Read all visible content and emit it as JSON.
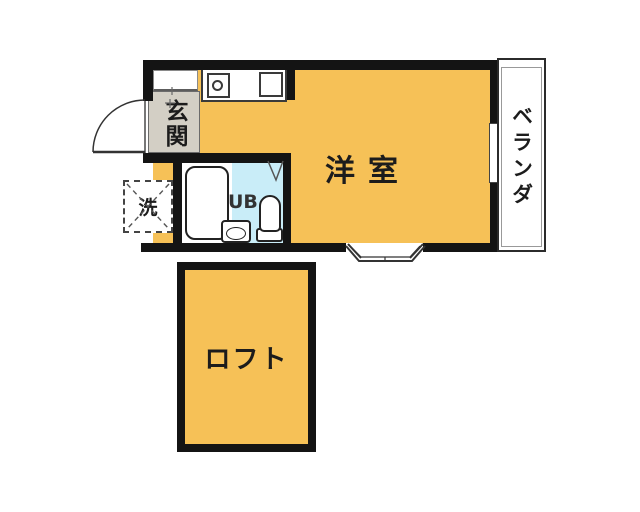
{
  "floorplan": {
    "labels": {
      "entrance": "玄関",
      "main_room": "洋室",
      "unit_bath": "UB",
      "washer_space": "洗",
      "balcony": "ベランダ",
      "loft": "ロフト"
    },
    "colors": {
      "room": "#f6c157",
      "entrance": "#d3cfc5",
      "bath": "#c9edf8",
      "wall": "#141414"
    },
    "fixtures": [
      "stove-burner",
      "kitchen-sink",
      "bathtub",
      "washbasin",
      "toilet",
      "entrance-door-swing",
      "bay-window",
      "balcony-window",
      "shoe-closet"
    ]
  }
}
